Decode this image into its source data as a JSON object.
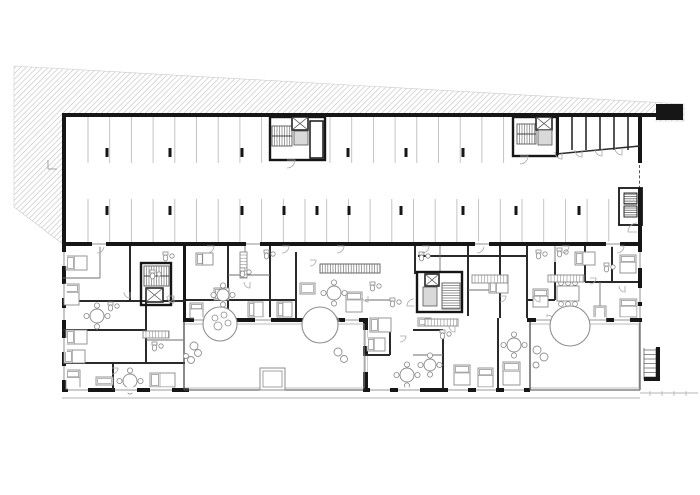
{
  "meta": {
    "drawing_type": "architectural-floor-plan",
    "content": "residential building ground floor: parking garage with stalls and columns (top), apartment units with furniture (bottom), two courtyards with trees, terrain hatch at top-left"
  },
  "canvas": {
    "w": 700,
    "h": 495
  },
  "colors": {
    "bg": "#ffffff",
    "wall": "#161616",
    "midwall": "#2a2a2a",
    "thin": "#6e6e6e",
    "stall": "#bdbdbd",
    "hatch": "#cccccc",
    "furn": "#8a8a8a",
    "door": "#a9a9a9",
    "window": "#9a9a9a",
    "tree": "#8f8f8f",
    "cab": "#d9d9d9",
    "ground": "#b5b5b5"
  },
  "terrain": {
    "polygon": "14,66 684,104 684,121 656,121 656,115 64,115 64,245 14,207",
    "steps": [
      [
        48,
        160,
        48,
        169
      ],
      [
        48,
        169,
        57,
        169
      ]
    ]
  },
  "garage": {
    "stall_rows": [
      {
        "x1": 88,
        "x2": 263,
        "step": 21.7,
        "y1": 117,
        "y2": 163
      },
      {
        "x1": 330,
        "x2": 513,
        "step": 21.7,
        "y1": 117,
        "y2": 163
      },
      {
        "x1": 88,
        "x2": 621,
        "step": 21.7,
        "y1": 199,
        "y2": 242
      }
    ],
    "columns_top": [
      107,
      170,
      242,
      348,
      406,
      463
    ],
    "columns_top_y": 148,
    "columns_bottom": [
      107,
      170,
      242,
      284,
      317,
      349,
      401,
      463,
      516,
      579
    ],
    "columns_bottom_y": 206,
    "entry_block": [
      656,
      104,
      27,
      16
    ],
    "dashed_door": [
      639.5,
      165,
      639.5,
      188
    ],
    "storerooms": {
      "west_wall": [
        556,
        117,
        3,
        38
      ],
      "partitions_x": [
        572,
        586,
        600,
        614,
        628
      ],
      "part_y1": 117,
      "part_y2": 150,
      "slant": [
        556,
        154,
        640,
        146
      ],
      "doors": [
        [
          562,
          152,
          7,
          90
        ],
        [
          582,
          150,
          7,
          90
        ],
        [
          602,
          149,
          7,
          90
        ],
        [
          622,
          148,
          7,
          90
        ]
      ]
    },
    "vent_room": {
      "frame": [
        619,
        188,
        23,
        37
      ],
      "vents": [
        [
          624,
          193,
          13,
          11
        ],
        [
          624,
          206,
          13,
          11
        ]
      ],
      "door": [
        637,
        232,
        9,
        180
      ]
    }
  },
  "walls_thick": [
    [
      62,
      113,
      600,
      4
    ],
    [
      62,
      113,
      4,
      133
    ],
    [
      638,
      117,
      4,
      46
    ],
    [
      638,
      188,
      4,
      58
    ],
    [
      62,
      242,
      580,
      4
    ],
    [
      62,
      246,
      4,
      146
    ],
    [
      62,
      388,
      127,
      4
    ],
    [
      363,
      388,
      167,
      4
    ],
    [
      638,
      246,
      4,
      76
    ],
    [
      527,
      318,
      115,
      4
    ],
    [
      183,
      318,
      182,
      4
    ],
    [
      363,
      318,
      5,
      74
    ],
    [
      183,
      242,
      3,
      80
    ]
  ],
  "walls_mid": [
    [
      130,
      246,
      130,
      302
    ],
    [
      63,
      301,
      185,
      301
    ],
    [
      146,
      301,
      146,
      363
    ],
    [
      63,
      330,
      146,
      330
    ],
    [
      63,
      363,
      185,
      363
    ],
    [
      113,
      363,
      113,
      390
    ],
    [
      186,
      300,
      296,
      300
    ],
    [
      228,
      246,
      228,
      318
    ],
    [
      270,
      246,
      270,
      318
    ],
    [
      296,
      252,
      296,
      318
    ],
    [
      415,
      246,
      415,
      274
    ],
    [
      468,
      246,
      468,
      316
    ],
    [
      500,
      246,
      500,
      318
    ],
    [
      418,
      256,
      527,
      256
    ],
    [
      390,
      318,
      390,
      355
    ],
    [
      363,
      355,
      390,
      355
    ],
    [
      443,
      330,
      443,
      388
    ],
    [
      413,
      330,
      443,
      330
    ],
    [
      498,
      318,
      498,
      388
    ],
    [
      527,
      246,
      527,
      318
    ],
    [
      585,
      246,
      585,
      282
    ],
    [
      612,
      246,
      612,
      282
    ],
    [
      585,
      282,
      638,
      282
    ],
    [
      555,
      262,
      555,
      300
    ],
    [
      527,
      300,
      555,
      300
    ]
  ],
  "walls_thin": [
    [
      100,
      246,
      100,
      278
    ],
    [
      63,
      278,
      100,
      278
    ],
    [
      245,
      246,
      245,
      275
    ],
    [
      228,
      275,
      270,
      275
    ],
    [
      440,
      246,
      440,
      272
    ],
    [
      365,
      300,
      390,
      300
    ],
    [
      468,
      290,
      500,
      290
    ],
    [
      555,
      246,
      555,
      262
    ],
    [
      600,
      282,
      600,
      318
    ],
    [
      146,
      340,
      183,
      340
    ],
    [
      413,
      355,
      443,
      355
    ]
  ],
  "cores": [
    {
      "frame": [
        270,
        117,
        55,
        43
      ],
      "stair": [
        272,
        126,
        20,
        20,
        "v"
      ],
      "elev": [
        292,
        117,
        16,
        13
      ],
      "cab": [
        294,
        131,
        14,
        14
      ],
      "side": [
        310,
        121,
        13,
        37
      ],
      "door": [
        287,
        160,
        8,
        0
      ]
    },
    {
      "frame": [
        513,
        117,
        44,
        39
      ],
      "stair": [
        517,
        124,
        19,
        20,
        "v"
      ],
      "elev": [
        536,
        117,
        16,
        13
      ],
      "cab": [
        538,
        130,
        14,
        15
      ],
      "side": null,
      "door": [
        520,
        156,
        8,
        0
      ]
    },
    {
      "frame": [
        141,
        263,
        30,
        42
      ],
      "stair": [
        144,
        266,
        25,
        20,
        "v"
      ],
      "elev": [
        146,
        288,
        17,
        14
      ],
      "cab": null,
      "side": null,
      "door": [
        174,
        296,
        7,
        90
      ]
    },
    {
      "frame": [
        417,
        272,
        45,
        40
      ],
      "stair": [
        442,
        283,
        18,
        26,
        "h"
      ],
      "elev": [
        425,
        274,
        14,
        12
      ],
      "cab": [
        423,
        287,
        14,
        19
      ],
      "side": null,
      "door": [
        414,
        306,
        7,
        180
      ]
    }
  ],
  "long_stair": [
    320,
    264,
    60,
    9
  ],
  "furniture": {
    "beds": [
      [
        66,
        256,
        21,
        14
      ],
      [
        64,
        284,
        15,
        21
      ],
      [
        66,
        330,
        21,
        14
      ],
      [
        64,
        350,
        21,
        13
      ],
      [
        66,
        370,
        14,
        19
      ],
      [
        150,
        373,
        25,
        14
      ],
      [
        190,
        303,
        13,
        15
      ],
      [
        196,
        253,
        17,
        12
      ],
      [
        214,
        288,
        15,
        12
      ],
      [
        248,
        302,
        15,
        15
      ],
      [
        277,
        302,
        15,
        15
      ],
      [
        346,
        292,
        16,
        20
      ],
      [
        370,
        318,
        21,
        14
      ],
      [
        367,
        338,
        18,
        13
      ],
      [
        454,
        365,
        16,
        20
      ],
      [
        478,
        368,
        15,
        19
      ],
      [
        503,
        362,
        17,
        23
      ],
      [
        489,
        280,
        19,
        13
      ],
      [
        575,
        252,
        20,
        13
      ],
      [
        620,
        255,
        16,
        18
      ],
      [
        620,
        299,
        17,
        18
      ],
      [
        533,
        289,
        15,
        18
      ]
    ],
    "tables_round": [
      [
        97,
        316,
        7
      ],
      [
        130,
        381,
        7
      ],
      [
        223,
        295,
        6
      ],
      [
        334,
        293,
        7
      ],
      [
        407,
        375,
        7
      ],
      [
        430,
        365,
        6
      ],
      [
        514,
        345,
        7
      ]
    ],
    "tables_rect": [
      [
        557,
        286,
        22,
        15
      ]
    ],
    "sofas": [
      [
        96,
        377,
        17,
        8
      ],
      [
        300,
        283,
        15,
        11
      ],
      [
        418,
        318,
        13,
        8
      ],
      [
        594,
        306,
        12,
        16
      ]
    ],
    "kitchens": [
      [
        472,
        275,
        36,
        8
      ],
      [
        548,
        275,
        36,
        7
      ],
      [
        425,
        319,
        33,
        7
      ],
      [
        143,
        331,
        26,
        7
      ],
      [
        240,
        252,
        7,
        26
      ]
    ],
    "baths": [
      [
        150,
        270
      ],
      [
        163,
        252
      ],
      [
        240,
        268
      ],
      [
        264,
        250
      ],
      [
        390,
        298
      ],
      [
        440,
        330
      ],
      [
        536,
        250
      ],
      [
        557,
        248
      ],
      [
        604,
        263
      ],
      [
        419,
        252
      ],
      [
        108,
        302
      ],
      [
        152,
        342
      ],
      [
        370,
        282
      ]
    ]
  },
  "doors": [
    [
      97,
      246,
      7,
      0
    ],
    [
      207,
      246,
      7,
      0
    ],
    [
      282,
      246,
      7,
      0
    ],
    [
      337,
      246,
      7,
      0
    ],
    [
      422,
      246,
      7,
      0
    ],
    [
      477,
      246,
      7,
      0
    ],
    [
      562,
      246,
      7,
      0
    ],
    [
      617,
      246,
      7,
      0
    ],
    [
      212,
      322,
      7,
      270
    ],
    [
      332,
      322,
      7,
      270
    ],
    [
      547,
      322,
      7,
      270
    ],
    [
      130,
      292,
      6,
      90
    ],
    [
      168,
      296,
      6,
      0
    ],
    [
      250,
      282,
      6,
      90
    ],
    [
      310,
      260,
      6,
      0
    ],
    [
      368,
      296,
      6,
      90
    ],
    [
      400,
      336,
      6,
      0
    ],
    [
      455,
      326,
      6,
      90
    ],
    [
      500,
      296,
      6,
      0
    ],
    [
      540,
      296,
      6,
      90
    ],
    [
      590,
      278,
      6,
      0
    ],
    [
      112,
      368,
      6,
      0
    ],
    [
      625,
      286,
      6,
      90
    ]
  ],
  "windows": [
    {
      "o": "v",
      "x": 64,
      "y": 252,
      "l": 14
    },
    {
      "o": "v",
      "x": 64,
      "y": 284,
      "l": 14
    },
    {
      "o": "v",
      "x": 64,
      "y": 308,
      "l": 12
    },
    {
      "o": "v",
      "x": 64,
      "y": 338,
      "l": 14
    },
    {
      "o": "v",
      "x": 64,
      "y": 366,
      "l": 14
    },
    {
      "o": "h",
      "x": 68,
      "y": 390,
      "l": 20
    },
    {
      "o": "h",
      "x": 115,
      "y": 390,
      "l": 22
    },
    {
      "o": "h",
      "x": 150,
      "y": 390,
      "l": 22
    },
    {
      "o": "h",
      "x": 370,
      "y": 390,
      "l": 20
    },
    {
      "o": "h",
      "x": 398,
      "y": 390,
      "l": 22
    },
    {
      "o": "h",
      "x": 448,
      "y": 390,
      "l": 20
    },
    {
      "o": "h",
      "x": 476,
      "y": 390,
      "l": 20
    },
    {
      "o": "h",
      "x": 504,
      "y": 390,
      "l": 20
    },
    {
      "o": "v",
      "x": 640,
      "y": 252,
      "l": 16
    },
    {
      "o": "v",
      "x": 640,
      "y": 288,
      "l": 14
    },
    {
      "o": "v",
      "x": 640,
      "y": 306,
      "l": 12
    },
    {
      "o": "h",
      "x": 92,
      "y": 244,
      "l": 14
    },
    {
      "o": "h",
      "x": 246,
      "y": 244,
      "l": 14
    },
    {
      "o": "h",
      "x": 475,
      "y": 244,
      "l": 14
    },
    {
      "o": "h",
      "x": 606,
      "y": 244,
      "l": 14
    },
    {
      "o": "h",
      "x": 536,
      "y": 320,
      "l": 20
    },
    {
      "o": "h",
      "x": 588,
      "y": 320,
      "l": 18
    },
    {
      "o": "h",
      "x": 614,
      "y": 320,
      "l": 16
    },
    {
      "o": "h",
      "x": 194,
      "y": 320,
      "l": 16
    },
    {
      "o": "h",
      "x": 255,
      "y": 320,
      "l": 16
    },
    {
      "o": "h",
      "x": 345,
      "y": 320,
      "l": 14
    },
    {
      "o": "v",
      "x": 365,
      "y": 330,
      "l": 16
    },
    {
      "o": "v",
      "x": 365,
      "y": 356,
      "l": 16
    }
  ],
  "landscape": {
    "courtyards": [
      {
        "edge": [
          184,
          324,
          180,
          64
        ],
        "left_line": [
          184,
          322,
          184,
          390
        ],
        "bottom": [
          184,
          390,
          364,
          390
        ]
      },
      {
        "edge": [
          530,
          324,
          109,
          64
        ],
        "left_line": [
          530,
          322,
          530,
          390
        ],
        "bottom": [
          530,
          390,
          640,
          390
        ]
      }
    ],
    "right_edge_line": [
      640,
      322,
      640,
      390
    ],
    "trees": [
      {
        "c": [
          220,
          324,
          17
        ],
        "inner": [
          [
            215,
            318,
            3
          ],
          [
            224,
            315,
            3
          ],
          [
            218,
            326,
            4
          ],
          [
            228,
            323,
            3
          ]
        ]
      },
      {
        "c": [
          320,
          325,
          18
        ],
        "inner": []
      },
      {
        "c": [
          570,
          326,
          20
        ],
        "inner": []
      }
    ],
    "bushes": [
      [
        194,
        346,
        4
      ],
      [
        198,
        353,
        3.5
      ],
      [
        191,
        360,
        3.5
      ],
      [
        186,
        356,
        2.5
      ],
      [
        338,
        352,
        4
      ],
      [
        344,
        359,
        3.5
      ],
      [
        537,
        350,
        4
      ],
      [
        544,
        357,
        4
      ],
      [
        536,
        365,
        3
      ]
    ],
    "planter": {
      "outer": [
        260,
        368,
        25,
        22
      ],
      "inner": [
        263,
        371,
        19,
        16
      ]
    }
  },
  "exterior": {
    "ladder": {
      "rails": [
        [
          644,
          348,
          644,
          380
        ],
        [
          656,
          348,
          656,
          380
        ]
      ],
      "rungs_y1": 350,
      "rungs_y2": 378,
      "rung_step": 4.5,
      "x1": 644,
      "x2": 656,
      "black": [
        [
          656,
          347,
          4,
          34
        ],
        [
          644,
          377,
          16,
          4
        ]
      ]
    },
    "ground_lines": [
      [
        62,
        398,
        640,
        398
      ],
      [
        640,
        393,
        698,
        393
      ]
    ],
    "ticks": [
      [
        650,
        391,
        650,
        396
      ],
      [
        662,
        391,
        662,
        396
      ],
      [
        674,
        391,
        674,
        396
      ],
      [
        686,
        391,
        686,
        396
      ]
    ]
  }
}
